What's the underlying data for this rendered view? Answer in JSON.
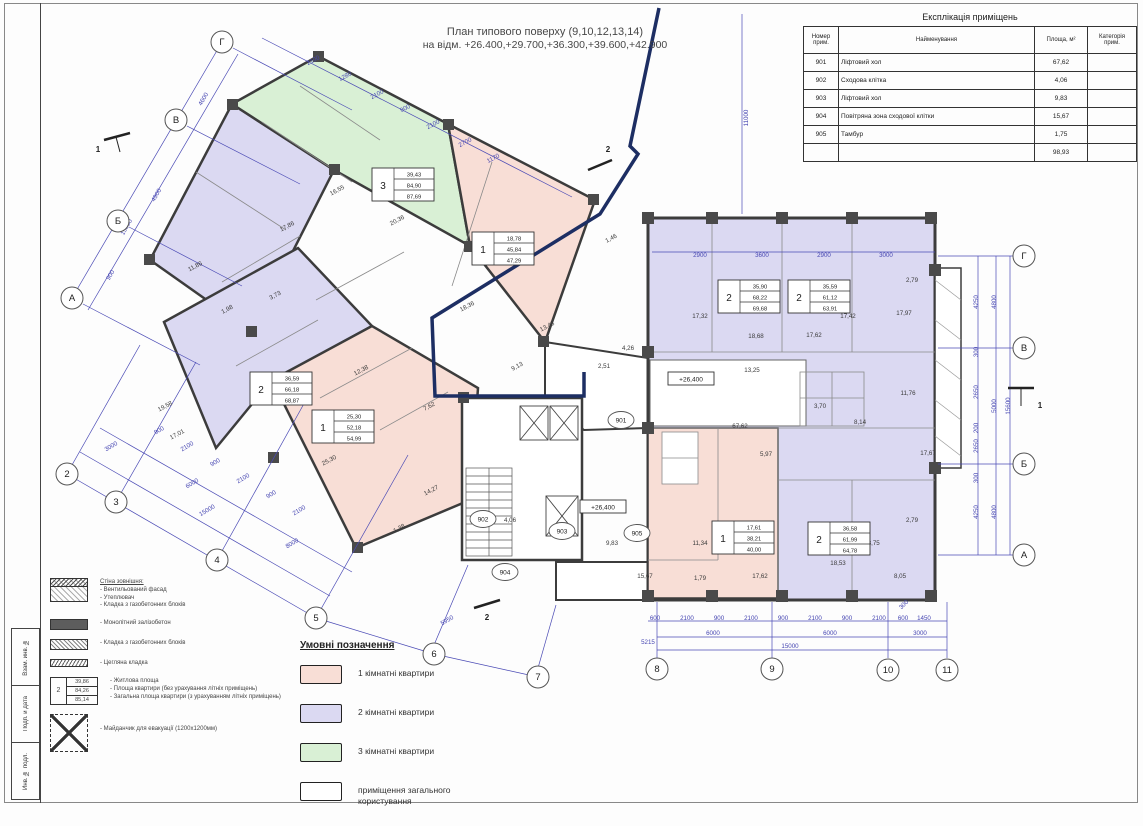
{
  "title": {
    "line1": "План типового поверху (9,10,12,13,14)",
    "line2": "на відм. +26.400,+29.700,+36.300,+39.600,+42.900"
  },
  "explication": {
    "title": "Експлікація приміщень",
    "headers": {
      "num": "Номер\nприм.",
      "name": "Найменування",
      "area": "Площа, м²",
      "cat": "Категорія\nприм."
    },
    "rows": [
      {
        "num": "901",
        "name": "Ліфтовий хол",
        "area": "67,62",
        "cat": ""
      },
      {
        "num": "902",
        "name": "Сходова клітка",
        "area": "4,06",
        "cat": ""
      },
      {
        "num": "903",
        "name": "Ліфтовий хол",
        "area": "9,83",
        "cat": ""
      },
      {
        "num": "904",
        "name": "Повітряна зона сходової клітки",
        "area": "15,67",
        "cat": ""
      },
      {
        "num": "905",
        "name": "Тамбур",
        "area": "1,75",
        "cat": ""
      },
      {
        "num": "",
        "name": "",
        "area": "98,93",
        "cat": ""
      }
    ]
  },
  "legend": {
    "title": "Умовні позначення",
    "items": [
      {
        "label": "1 кімнатні квартири",
        "color": "#f8ded6"
      },
      {
        "label": "2 кімнатні квартири",
        "color": "#dbd9f2"
      },
      {
        "label": "3 кімнатні квартири",
        "color": "#d9f0d5"
      },
      {
        "label": "приміщення загального користування",
        "color": "#ffffff"
      }
    ]
  },
  "materials_legend": {
    "wall_title": "Стіна зовнішня:",
    "wall_lines": "- Вентильований фасад\n- Утеплювач\n- Кладка з газобетонних блоків",
    "monolith": "- Монолітний залізобетон",
    "blocks": "- Кладка з газобетонних блоків",
    "brick": "- Цегляна кладка",
    "stamp_notes": "- Житлова площа\n- Площа квартири (без урахування літніх приміщень)\n- Загальна площа квартири (з урахуванням літніх приміщень)",
    "stamp_sample": {
      "rooms": "2",
      "living": "39,86",
      "apt": "84,26",
      "total": "85,14"
    },
    "evac": "- Майданчик для евакуації (1200х1200мм)"
  },
  "frame": {
    "stamps": [
      "Взам. инв. №",
      "Подп. и дата",
      "Инв. № подл."
    ]
  },
  "plan": {
    "colors": {
      "one_room": "#f8ded6",
      "two_room": "#dbd9f2",
      "three_room": "#d9f0d5",
      "walls": "#3c3c3c",
      "dims": "#4646b2",
      "section_line": "#1d2e63"
    },
    "axis_circles": [
      {
        "t": "Г",
        "x": 222,
        "y": 42
      },
      {
        "t": "В",
        "x": 176,
        "y": 120
      },
      {
        "t": "Б",
        "x": 118,
        "y": 221
      },
      {
        "t": "А",
        "x": 72,
        "y": 298
      },
      {
        "t": "Г",
        "x": 1024,
        "y": 256
      },
      {
        "t": "В",
        "x": 1024,
        "y": 348
      },
      {
        "t": "Б",
        "x": 1024,
        "y": 464
      },
      {
        "t": "А",
        "x": 1024,
        "y": 555
      },
      {
        "t": "2",
        "x": 67,
        "y": 474
      },
      {
        "t": "3",
        "x": 116,
        "y": 502
      },
      {
        "t": "4",
        "x": 217,
        "y": 560
      },
      {
        "t": "5",
        "x": 316,
        "y": 618
      },
      {
        "t": "6",
        "x": 434,
        "y": 654
      },
      {
        "t": "7",
        "x": 538,
        "y": 677
      },
      {
        "t": "8",
        "x": 657,
        "y": 669
      },
      {
        "t": "9",
        "x": 772,
        "y": 669
      },
      {
        "t": "10",
        "x": 888,
        "y": 670
      },
      {
        "t": "11",
        "x": 947,
        "y": 670
      }
    ],
    "room_circles": [
      {
        "t": "901",
        "x": 621,
        "y": 420
      },
      {
        "t": "902",
        "x": 483,
        "y": 519
      },
      {
        "t": "903",
        "x": 562,
        "y": 531
      },
      {
        "t": "904",
        "x": 505,
        "y": 572
      },
      {
        "t": "905",
        "x": 637,
        "y": 533
      }
    ],
    "stamps": [
      {
        "n": "3",
        "a": "39,43",
        "b": "84,90",
        "c": "87,69",
        "x": 372,
        "y": 168
      },
      {
        "n": "1",
        "a": "18,78",
        "b": "45,84",
        "c": "47,29",
        "x": 472,
        "y": 232
      },
      {
        "n": "2",
        "a": "36,59",
        "b": "66,18",
        "c": "68,87",
        "x": 250,
        "y": 372
      },
      {
        "n": "1",
        "a": "25,30",
        "b": "52,18",
        "c": "54,99",
        "x": 312,
        "y": 410
      },
      {
        "n": "2",
        "a": "35,90",
        "b": "68,22",
        "c": "69,68",
        "x": 718,
        "y": 280
      },
      {
        "n": "2",
        "a": "35,59",
        "b": "61,12",
        "c": "63,91",
        "x": 788,
        "y": 280
      },
      {
        "n": "1",
        "a": "17,61",
        "b": "38,21",
        "c": "40,00",
        "x": 712,
        "y": 521
      },
      {
        "n": "2",
        "a": "36,58",
        "b": "61,99",
        "c": "64,78",
        "x": 808,
        "y": 522
      }
    ],
    "area_labels": [
      {
        "t": "16,55",
        "x": 338,
        "y": 192,
        "r": -28
      },
      {
        "t": "20,36",
        "x": 398,
        "y": 222,
        "r": -28
      },
      {
        "t": "11,86",
        "x": 196,
        "y": 268,
        "r": -28
      },
      {
        "t": "17,86",
        "x": 288,
        "y": 228,
        "r": -28
      },
      {
        "t": "3,73",
        "x": 276,
        "y": 297,
        "r": -28
      },
      {
        "t": "1,98",
        "x": 228,
        "y": 311,
        "r": -28
      },
      {
        "t": "12,38",
        "x": 362,
        "y": 372,
        "r": -28
      },
      {
        "t": "19,58",
        "x": 166,
        "y": 408,
        "r": -28
      },
      {
        "t": "17,01",
        "x": 178,
        "y": 436,
        "r": -28
      },
      {
        "t": "7,62",
        "x": 430,
        "y": 408,
        "r": -28
      },
      {
        "t": "14,27",
        "x": 432,
        "y": 492,
        "r": -28
      },
      {
        "t": "1,38",
        "x": 400,
        "y": 530,
        "r": -28
      },
      {
        "t": "25,30",
        "x": 330,
        "y": 462,
        "r": -28
      },
      {
        "t": "18,36",
        "x": 468,
        "y": 308,
        "r": -28
      },
      {
        "t": "13,48",
        "x": 548,
        "y": 328,
        "r": -28
      },
      {
        "t": "9,13",
        "x": 518,
        "y": 368,
        "r": -28
      },
      {
        "t": "1,46",
        "x": 612,
        "y": 240,
        "r": -28
      },
      {
        "t": "4,26",
        "x": 628,
        "y": 350,
        "r": 0
      },
      {
        "t": "2,51",
        "x": 604,
        "y": 368,
        "r": 0
      },
      {
        "t": "4,06",
        "x": 510,
        "y": 522,
        "r": 0
      },
      {
        "t": "9,83",
        "x": 612,
        "y": 545,
        "r": 0
      },
      {
        "t": "15,67",
        "x": 645,
        "y": 578,
        "r": 0
      },
      {
        "t": "17,32",
        "x": 700,
        "y": 318,
        "r": 0
      },
      {
        "t": "18,68",
        "x": 756,
        "y": 338,
        "r": 0
      },
      {
        "t": "17,62",
        "x": 814,
        "y": 337,
        "r": 0
      },
      {
        "t": "13,25",
        "x": 752,
        "y": 372,
        "r": 0
      },
      {
        "t": "17,42",
        "x": 848,
        "y": 318,
        "r": 0
      },
      {
        "t": "17,97",
        "x": 904,
        "y": 315,
        "r": 0
      },
      {
        "t": "2,79",
        "x": 912,
        "y": 282,
        "r": 0
      },
      {
        "t": "11,76",
        "x": 908,
        "y": 395,
        "r": 0
      },
      {
        "t": "8,14",
        "x": 860,
        "y": 424,
        "r": 0
      },
      {
        "t": "3,70",
        "x": 820,
        "y": 408,
        "r": 0
      },
      {
        "t": "5,97",
        "x": 766,
        "y": 456,
        "r": 0
      },
      {
        "t": "67,62",
        "x": 740,
        "y": 428,
        "r": 0
      },
      {
        "t": "17,67",
        "x": 928,
        "y": 455,
        "r": 0
      },
      {
        "t": "2,79",
        "x": 912,
        "y": 522,
        "r": 0
      },
      {
        "t": "11,34",
        "x": 700,
        "y": 545,
        "r": 0
      },
      {
        "t": "17,62",
        "x": 760,
        "y": 578,
        "r": 0
      },
      {
        "t": "1,79",
        "x": 700,
        "y": 580,
        "r": 0
      },
      {
        "t": "18,53",
        "x": 838,
        "y": 565,
        "r": 0
      },
      {
        "t": "18,75",
        "x": 872,
        "y": 545,
        "r": 0
      },
      {
        "t": "8,05",
        "x": 900,
        "y": 578,
        "r": 0
      }
    ],
    "dim_labels": [
      {
        "t": "4600",
        "x": 205,
        "y": 100,
        "r": -60
      },
      {
        "t": "4900",
        "x": 158,
        "y": 196,
        "r": -60
      },
      {
        "t": "900",
        "x": 112,
        "y": 276,
        "r": -60
      },
      {
        "t": "15800",
        "x": 128,
        "y": 228,
        "r": -60
      },
      {
        "t": "2100",
        "x": 314,
        "y": 62,
        "r": -28
      },
      {
        "t": "1280",
        "x": 346,
        "y": 78,
        "r": -28
      },
      {
        "t": "2100",
        "x": 378,
        "y": 96,
        "r": -28
      },
      {
        "t": "900",
        "x": 406,
        "y": 110,
        "r": -28
      },
      {
        "t": "2100",
        "x": 434,
        "y": 126,
        "r": -28
      },
      {
        "t": "2700",
        "x": 466,
        "y": 144,
        "r": -28
      },
      {
        "t": "1170",
        "x": 494,
        "y": 160,
        "r": -28
      },
      {
        "t": "11000",
        "x": 748,
        "y": 118,
        "r": -90
      },
      {
        "t": "2900",
        "x": 700,
        "y": 257,
        "r": 0
      },
      {
        "t": "3600",
        "x": 762,
        "y": 257,
        "r": 0
      },
      {
        "t": "2900",
        "x": 824,
        "y": 257,
        "r": 0
      },
      {
        "t": "3000",
        "x": 886,
        "y": 257,
        "r": 0
      },
      {
        "t": "3000",
        "x": 112,
        "y": 448,
        "r": -31
      },
      {
        "t": "6000",
        "x": 193,
        "y": 485,
        "r": -31
      },
      {
        "t": "15000",
        "x": 208,
        "y": 512,
        "r": -31
      },
      {
        "t": "8000",
        "x": 293,
        "y": 545,
        "r": -31
      },
      {
        "t": "900",
        "x": 160,
        "y": 432,
        "r": -31
      },
      {
        "t": "2100",
        "x": 188,
        "y": 448,
        "r": -31
      },
      {
        "t": "900",
        "x": 216,
        "y": 464,
        "r": -31
      },
      {
        "t": "2100",
        "x": 244,
        "y": 480,
        "r": -31
      },
      {
        "t": "900",
        "x": 272,
        "y": 496,
        "r": -31
      },
      {
        "t": "2100",
        "x": 300,
        "y": 512,
        "r": -31
      },
      {
        "t": "5950",
        "x": 448,
        "y": 622,
        "r": -31
      },
      {
        "t": "5215",
        "x": 648,
        "y": 644,
        "r": 0
      },
      {
        "t": "600",
        "x": 655,
        "y": 620,
        "r": 0
      },
      {
        "t": "2100",
        "x": 687,
        "y": 620,
        "r": 0
      },
      {
        "t": "900",
        "x": 719,
        "y": 620,
        "r": 0
      },
      {
        "t": "2100",
        "x": 751,
        "y": 620,
        "r": 0
      },
      {
        "t": "900",
        "x": 783,
        "y": 620,
        "r": 0
      },
      {
        "t": "2100",
        "x": 815,
        "y": 620,
        "r": 0
      },
      {
        "t": "900",
        "x": 847,
        "y": 620,
        "r": 0
      },
      {
        "t": "2100",
        "x": 879,
        "y": 620,
        "r": 0
      },
      {
        "t": "600",
        "x": 903,
        "y": 620,
        "r": 0
      },
      {
        "t": "1450",
        "x": 924,
        "y": 620,
        "r": 0
      },
      {
        "t": "300",
        "x": 905,
        "y": 606,
        "r": -45
      },
      {
        "t": "6000",
        "x": 713,
        "y": 635,
        "r": 0
      },
      {
        "t": "6000",
        "x": 830,
        "y": 635,
        "r": 0
      },
      {
        "t": "3000",
        "x": 920,
        "y": 635,
        "r": 0
      },
      {
        "t": "15000",
        "x": 790,
        "y": 648,
        "r": 0
      },
      {
        "t": "4250",
        "x": 978,
        "y": 302,
        "r": -90
      },
      {
        "t": "300",
        "x": 978,
        "y": 352,
        "r": -90
      },
      {
        "t": "2650",
        "x": 978,
        "y": 392,
        "r": -90
      },
      {
        "t": "200",
        "x": 978,
        "y": 428,
        "r": -90
      },
      {
        "t": "2650",
        "x": 978,
        "y": 446,
        "r": -90
      },
      {
        "t": "300",
        "x": 978,
        "y": 478,
        "r": -90
      },
      {
        "t": "4250",
        "x": 978,
        "y": 512,
        "r": -90
      },
      {
        "t": "4800",
        "x": 996,
        "y": 302,
        "r": -90
      },
      {
        "t": "5000",
        "x": 996,
        "y": 406,
        "r": -90
      },
      {
        "t": "4800",
        "x": 996,
        "y": 512,
        "r": -90
      },
      {
        "t": "15600",
        "x": 1010,
        "y": 406,
        "r": -90
      }
    ],
    "elevation_marks": [
      {
        "t": "+26,400",
        "x": 580,
        "y": 500
      },
      {
        "t": "+26,400",
        "x": 668,
        "y": 372
      }
    ],
    "section_labels": [
      {
        "t": "1",
        "x": 98,
        "y": 152
      },
      {
        "t": "1",
        "x": 1040,
        "y": 408
      },
      {
        "t": "2",
        "x": 608,
        "y": 152
      },
      {
        "t": "2",
        "x": 487,
        "y": 620
      }
    ]
  }
}
